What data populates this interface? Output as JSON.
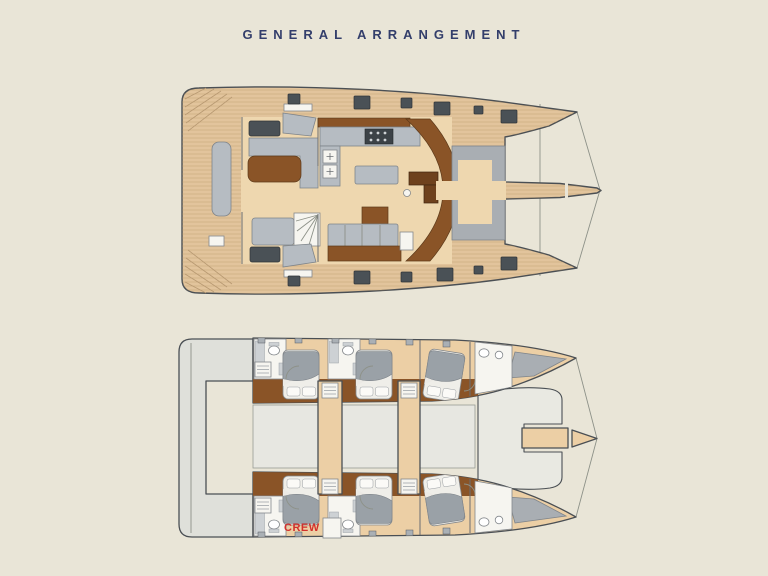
{
  "title": {
    "text": "GENERAL ARRANGEMENT"
  },
  "labels": {
    "crew": "CREW"
  },
  "palette": {
    "background": "#e9e5d7",
    "navy": "#333e6b",
    "crew-red": "#d2302c",
    "deck-tan": "#e2c49c",
    "floor-tan": "#eed7af",
    "cabin-tan": "#eccfa5",
    "plank": "#b3905f",
    "wood-brown": "#8a5427",
    "dark-brown": "#6e411d",
    "sofa-gray": "#b6bcc2",
    "hatch-gray": "#4a5156",
    "tramp-gray": "#a9aeb3",
    "platform-gray": "#dfe0da",
    "bridge-gray": "#e7e7e1",
    "bed-gray": "#9aa1a7",
    "white": "#f6f5f0",
    "outline": "#4a4f54",
    "thin": "#8d9188"
  }
}
